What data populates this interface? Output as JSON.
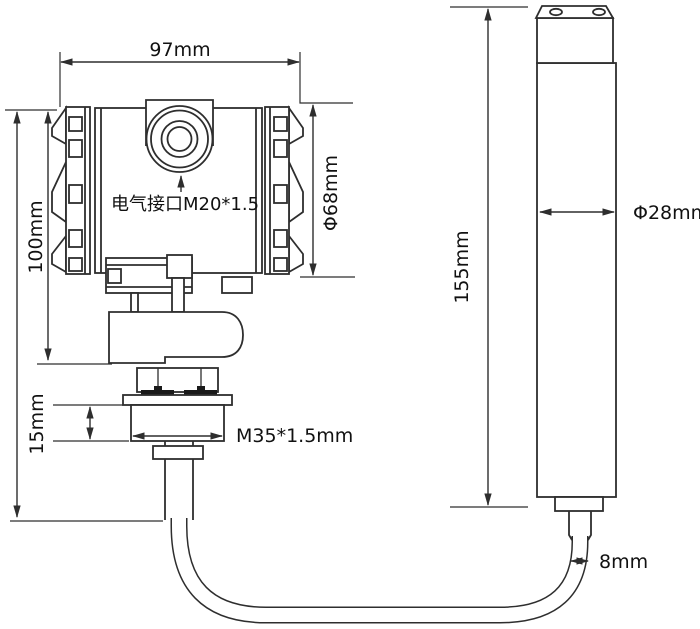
{
  "drawing": {
    "background": "#ffffff",
    "line_color": "#2e2e2e",
    "text_color": "#111111",
    "labels": {
      "top_width": "97mm",
      "left_height": "100mm",
      "electrical_port": "电气接口M20*1.5",
      "housing_diameter": "Φ68mm",
      "thread_length": "15mm",
      "thread_spec": "M35*1.5mm",
      "probe_length": "155mm",
      "probe_diameter": "Φ28mm",
      "cable_diameter": "8mm"
    }
  }
}
